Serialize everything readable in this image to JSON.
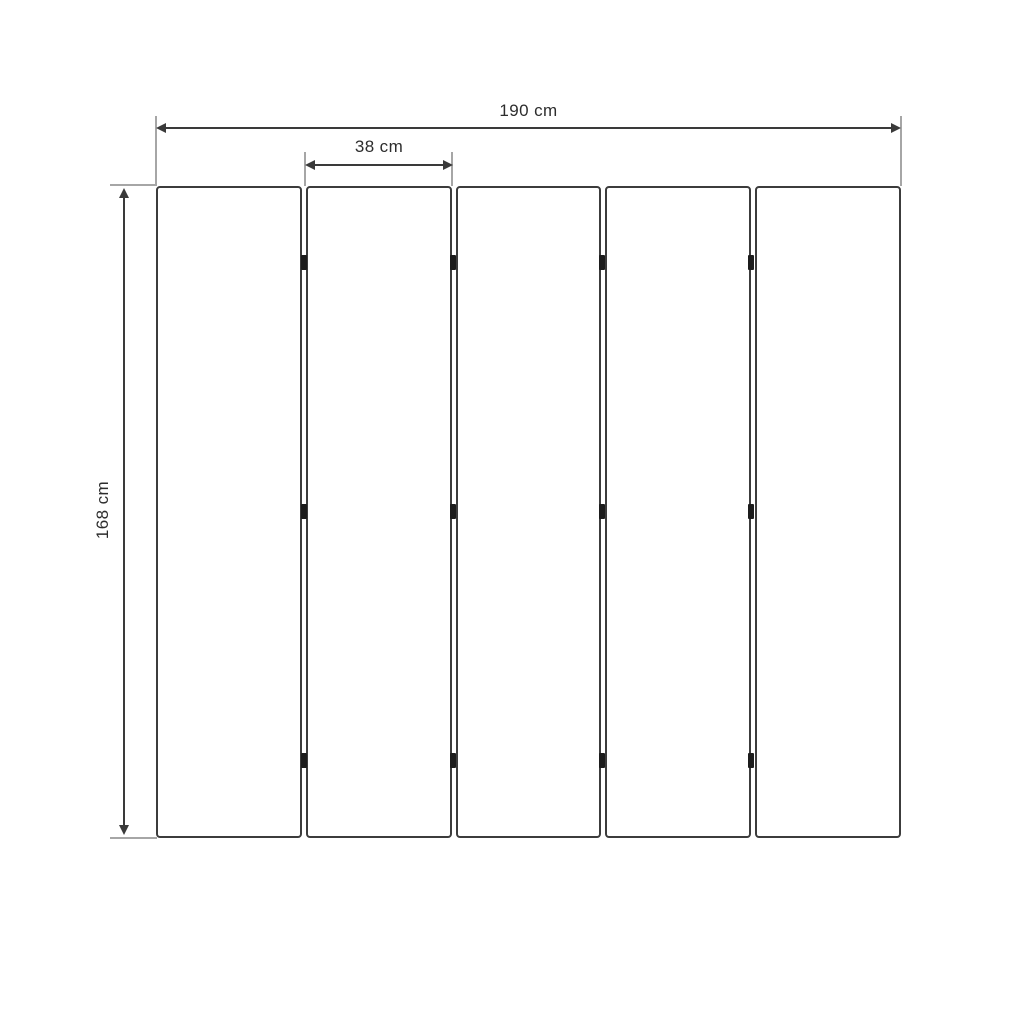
{
  "diagram": {
    "type": "panel-dimension-drawing",
    "panel_count": 5,
    "hinge_columns": 4,
    "hinge_rows": 3,
    "labels": {
      "total_width": "190 cm",
      "panel_width": "38 cm",
      "height": "168 cm"
    },
    "colors": {
      "panel_border": "#3c3c3c",
      "dimension_line": "#3a3a3a",
      "extension_line": "#a6a6a6",
      "hinge": "#1c1c1c",
      "text": "#2d2d2d",
      "background": "#ffffff"
    }
  }
}
